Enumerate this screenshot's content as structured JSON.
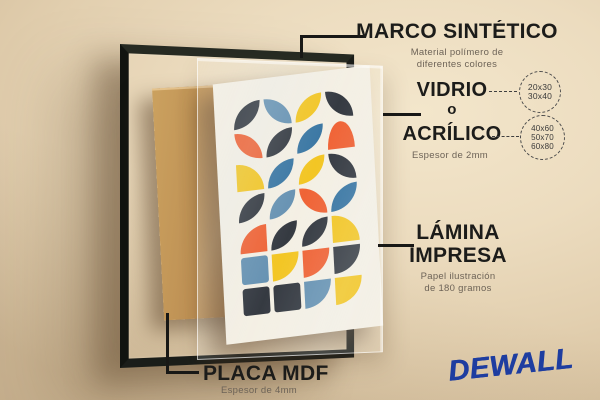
{
  "annotations": {
    "marco": {
      "title": "MARCO SINTÉTICO",
      "desc1": "Material polímero de",
      "desc2": "diferentes colores"
    },
    "vidrio": {
      "word1": "VIDRIO",
      "word2": "o",
      "word3": "ACRÍLICO",
      "desc": "Espesor de 2mm",
      "sizes_small": [
        "20x30",
        "30x40"
      ],
      "sizes_large": [
        "40x60",
        "50x70",
        "60x80"
      ]
    },
    "lamina": {
      "word1": "LÁMINA",
      "word2": "IMPRESA",
      "desc1": "Papel ilustración",
      "desc2": "de 180 gramos"
    },
    "placa": {
      "title": "PLACA MDF",
      "desc": "Espesor de 4mm"
    }
  },
  "brand": {
    "name": "DEWALL",
    "color": "#1e3da0"
  },
  "artwork": {
    "sheet_color": "#f4efe3",
    "palette": {
      "dark": "#2a2f37",
      "steel": "#5e8cae",
      "blue": "#2f6f9e",
      "yellow": "#f3c318",
      "orange": "#ef5b2b"
    },
    "grid": [
      [
        "dark tl-br",
        "steel tr-bl",
        "yellow tl-br",
        "dark tr-bl"
      ],
      [
        "orange tr-bl",
        "dark tl-br",
        "blue tl-br",
        "orange top"
      ],
      [
        "yellow tr",
        "blue tl-br",
        "yellow tl-br",
        "dark tr-bl"
      ],
      [
        "dark tl-br",
        "steel tl-br",
        "orange tr-bl",
        "blue tl-br"
      ],
      [
        "orange tl",
        "dark tl-br",
        "dark tl-br",
        "yellow tr"
      ],
      [
        "steel sq",
        "yellow br",
        "orange br",
        "dark br"
      ],
      [
        "dark sq",
        "dark sq",
        "steel br",
        "yellow br"
      ]
    ]
  }
}
